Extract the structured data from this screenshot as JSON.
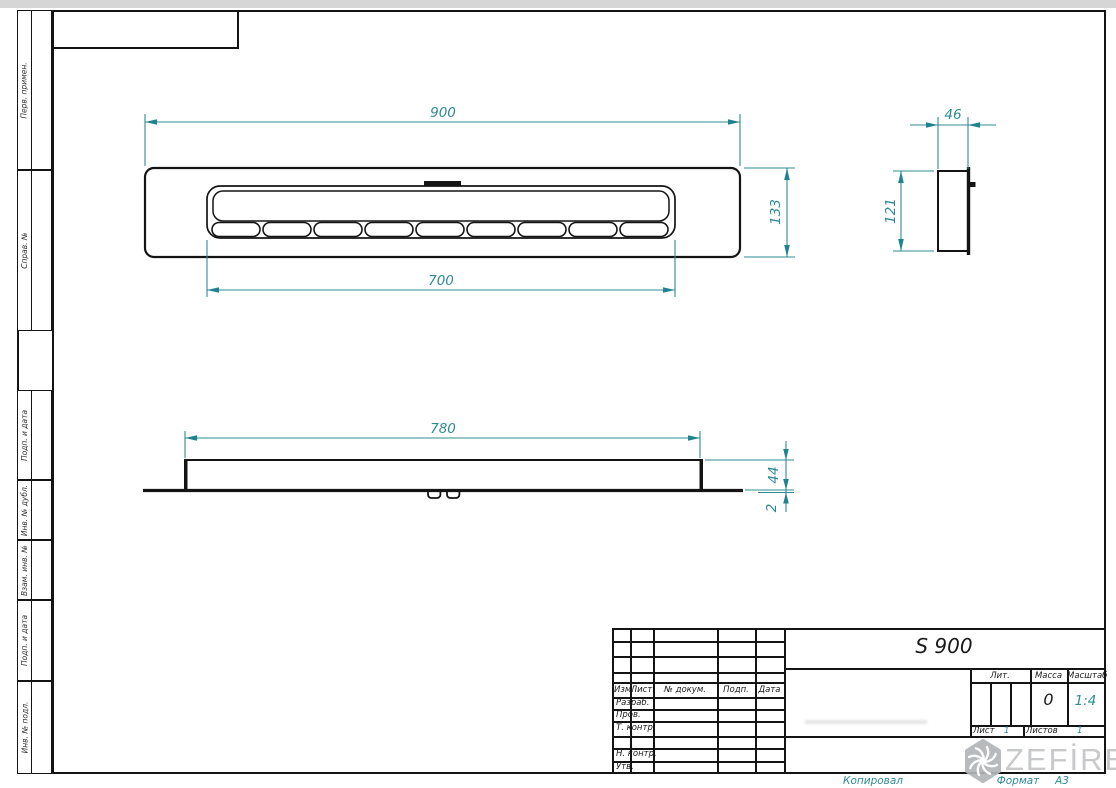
{
  "drawing": {
    "left_margin_labels": [
      "Перв. примен.",
      "Справ. №",
      "Подп. и дата",
      "Инв. № дубл.",
      "Взам. инв. №",
      "Подп. и дата",
      "Инв. № подл."
    ],
    "views": {
      "top_view": {
        "length": "900",
        "slot_length": "700",
        "width": "133",
        "burner_holes": 9
      },
      "side_view": {
        "depth": "46",
        "height": "121"
      },
      "front_view": {
        "length": "780",
        "height": "44",
        "base_thickness": "2"
      }
    },
    "title_block": {
      "model": "S 900",
      "columns": [
        "Изм.",
        "Лист",
        "№ докум.",
        "Подп.",
        "Дата"
      ],
      "staff_rows": [
        "Разраб.",
        "Пров.",
        "Т. контр.",
        "Н. контр.",
        "Утв."
      ],
      "lit_label": "Лит.",
      "mass_label": "Масса",
      "scale_label": "Масштаб",
      "mass_value": "0",
      "scale_value": "1:4",
      "sheet_label": "Лист",
      "sheet_value": "1",
      "sheets_label": "Листов",
      "sheets_value": "1"
    },
    "footer": {
      "copied_label": "Копировал",
      "format_label": "Формат",
      "format_value": "А3"
    },
    "brand": {
      "name": "ZEFİRE"
    },
    "colors": {
      "dimension": "#2e8b96",
      "line": "#141414"
    }
  }
}
